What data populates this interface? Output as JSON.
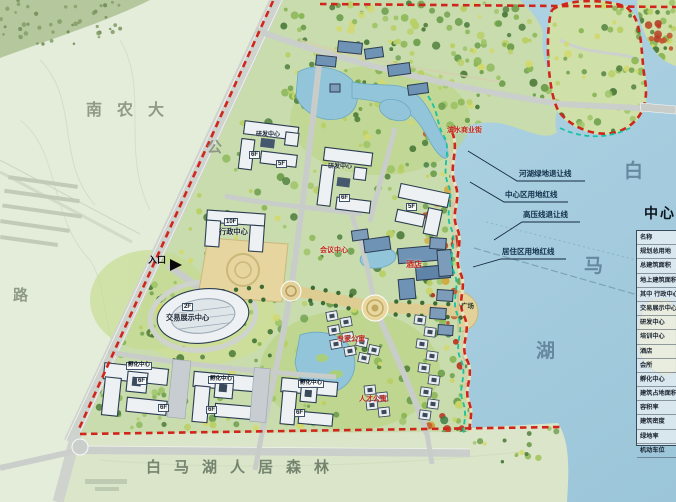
{
  "map_labels": {
    "campus": "南农大",
    "road_char_top": "公",
    "road_char_bottom": "路",
    "lake_char_1": "白",
    "lake_char_2": "马",
    "lake_char_3": "湖",
    "forest_band": "白马湖人居森林",
    "plaza": "广场"
  },
  "setback_labels": {
    "river_green": "河湖绿地退让线",
    "center_redline": "中心区用地红线",
    "high_voltage": "高压线退让线",
    "residential_redline": "居住区用地红线"
  },
  "entrance": {
    "label": "入口",
    "arrow": "▶"
  },
  "buildings": {
    "admin_floors": "10F",
    "admin_name": "行政中心",
    "exhibition_floors": "2F",
    "exhibition_name": "交易展示中心",
    "incubator_name": "孵化中心",
    "rnd_name": "研发中心",
    "hotel_name": "酒店",
    "conference_name": "会议中心",
    "commercial_name": "滨水商业街",
    "expert_apt_name": "专家公寓",
    "talent_apt_name": "人才公寓",
    "floor_6": "6F",
    "floor_5": "5F"
  },
  "info_table": {
    "title": "中心区",
    "rows": [
      "名称",
      "规划总用地",
      "总建筑面积",
      "地上建筑面积",
      "其中  行政中心",
      "交易展示中心",
      "研发中心",
      "培训中心",
      "酒店",
      "会所",
      "孵化中心",
      "建筑占地面积",
      "容积率",
      "建筑密度",
      "绿地率",
      "机动车位"
    ]
  },
  "colors": {
    "boundary_red": "#d0251a",
    "setback_teal": "#17c2a2",
    "lake_blue": "#a3cbdd",
    "label_red": "#c2271a"
  }
}
